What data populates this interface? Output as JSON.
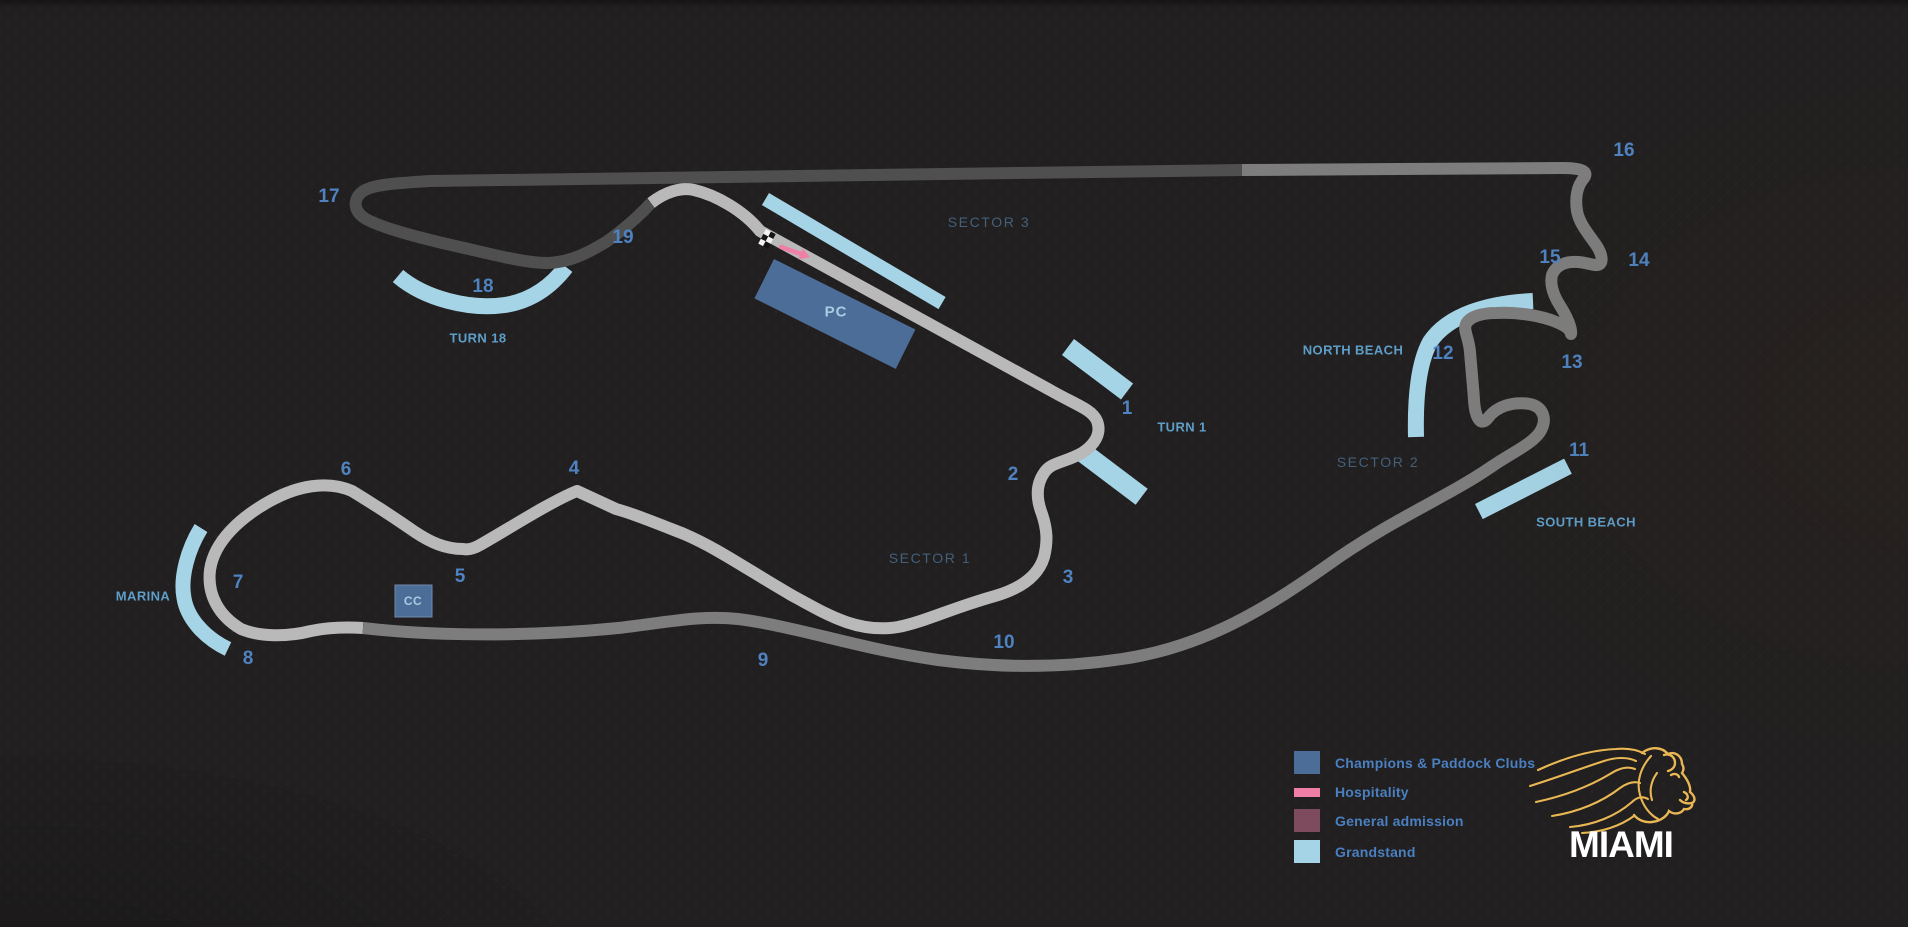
{
  "canvas": {
    "background": "#211f1f"
  },
  "colors": {
    "bg": "#211f1f",
    "sector1_track": "#b9b9b9",
    "sector2_track": "#7d7d7d",
    "sector3_track": "#4f4f4f",
    "grandstand": "#a5d4e6",
    "clubs": "#4d6d99",
    "clubs_border": "#7089ab",
    "hospitality": "#ef7fa7",
    "general_admission": "#7d4a5e",
    "turn_number_text": "#4e82c0",
    "area_name_text": "#5e9ec9",
    "sector_text": "#44607b",
    "facility_text": "#a9cce1",
    "legend_text": "#4a7fc0",
    "lion_gold": "#e9b753",
    "wordmark_text": "#ffffff",
    "flag_white": "#f2f2f2",
    "flag_black": "#141414"
  },
  "sectors": [
    {
      "name": "SECTOR 1",
      "track_color": "#b9b9b9"
    },
    {
      "name": "SECTOR 2",
      "track_color": "#7d7d7d"
    },
    {
      "name": "SECTOR 3",
      "track_color": "#4f4f4f"
    }
  ],
  "labels": [
    {
      "kind": "turn-number",
      "text": "1",
      "x": 1127,
      "y": 409
    },
    {
      "kind": "turn-number",
      "text": "2",
      "x": 1013,
      "y": 475
    },
    {
      "kind": "turn-number",
      "text": "3",
      "x": 1068,
      "y": 578
    },
    {
      "kind": "turn-number",
      "text": "4",
      "x": 574,
      "y": 469
    },
    {
      "kind": "turn-number",
      "text": "5",
      "x": 460,
      "y": 577
    },
    {
      "kind": "turn-number",
      "text": "6",
      "x": 346,
      "y": 470
    },
    {
      "kind": "turn-number",
      "text": "7",
      "x": 238,
      "y": 583
    },
    {
      "kind": "turn-number",
      "text": "8",
      "x": 248,
      "y": 659
    },
    {
      "kind": "turn-number",
      "text": "9",
      "x": 763,
      "y": 661
    },
    {
      "kind": "turn-number",
      "text": "10",
      "x": 1004,
      "y": 643
    },
    {
      "kind": "turn-number",
      "text": "11",
      "x": 1579,
      "y": 451
    },
    {
      "kind": "turn-number",
      "text": "12",
      "x": 1443,
      "y": 354
    },
    {
      "kind": "turn-number",
      "text": "13",
      "x": 1572,
      "y": 363
    },
    {
      "kind": "turn-number",
      "text": "14",
      "x": 1639,
      "y": 261
    },
    {
      "kind": "turn-number",
      "text": "15",
      "x": 1550,
      "y": 258
    },
    {
      "kind": "turn-number",
      "text": "16",
      "x": 1624,
      "y": 151
    },
    {
      "kind": "turn-number",
      "text": "17",
      "x": 329,
      "y": 197
    },
    {
      "kind": "turn-number",
      "text": "18",
      "x": 483,
      "y": 287
    },
    {
      "kind": "turn-number",
      "text": "19",
      "x": 623,
      "y": 238
    },
    {
      "kind": "area-name",
      "text": "TURN 1",
      "x": 1182,
      "y": 427
    },
    {
      "kind": "area-name",
      "text": "TURN 18",
      "x": 478,
      "y": 338
    },
    {
      "kind": "area-name",
      "text": "MARINA",
      "x": 143,
      "y": 596
    },
    {
      "kind": "area-name",
      "text": "NORTH BEACH",
      "x": 1353,
      "y": 350
    },
    {
      "kind": "area-name",
      "text": "SOUTH BEACH",
      "x": 1586,
      "y": 522
    },
    {
      "kind": "sector-name",
      "text": "SECTOR 1",
      "x": 930,
      "y": 558
    },
    {
      "kind": "sector-name",
      "text": "SECTOR 2",
      "x": 1378,
      "y": 462
    },
    {
      "kind": "sector-name",
      "text": "SECTOR 3",
      "x": 989,
      "y": 222
    },
    {
      "kind": "facility",
      "text": "PC",
      "x": 836,
      "y": 312
    },
    {
      "kind": "facility-small",
      "text": "CC",
      "x": 413,
      "y": 601
    }
  ],
  "legend": {
    "items": [
      {
        "label": "Champions & Paddock Clubs",
        "swatch": "square",
        "color_key": "clubs"
      },
      {
        "label": "Hospitality",
        "swatch": "bar",
        "color_key": "hospitality"
      },
      {
        "label": "General admission",
        "swatch": "square",
        "color_key": "general_admission"
      },
      {
        "label": "Grandstand",
        "swatch": "square",
        "color_key": "grandstand"
      }
    ]
  },
  "logo": {
    "wordmark": "MIAMI"
  }
}
